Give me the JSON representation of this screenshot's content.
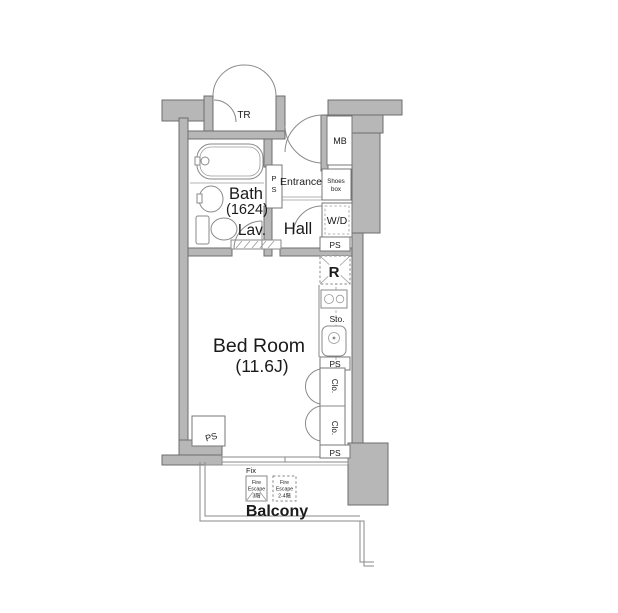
{
  "plan": {
    "rooms": {
      "bedroom_name": "Bed Room",
      "bedroom_size": "(11.6J)",
      "bath_name": "Bath",
      "bath_size": "(1624)",
      "lav": "Lav.",
      "hall": "Hall",
      "entrance": "Entrance",
      "balcony": "Balcony",
      "trunk": "TR",
      "meter_box": "MB",
      "washer_dryer": "W/D",
      "refrigerator": "R",
      "storage": "Sto.",
      "closet": "Clo.",
      "pipe_space": "PS",
      "pipe_p": "P",
      "pipe_s": "S",
      "shoes_line1": "Shoes",
      "shoes_line2": "box",
      "fix_window": "Fix"
    },
    "fire_escape_box1": [
      "Fire",
      "Escape",
      "3階"
    ],
    "fire_escape_box2": [
      "Fire",
      "Escape",
      "2-4階"
    ],
    "colors": {
      "wall_fill": "#b7b7b7",
      "wall_stroke": "#6e6e6e",
      "line": "#8a8a8a",
      "text": "#1a1a1a",
      "background": "#ffffff"
    }
  }
}
